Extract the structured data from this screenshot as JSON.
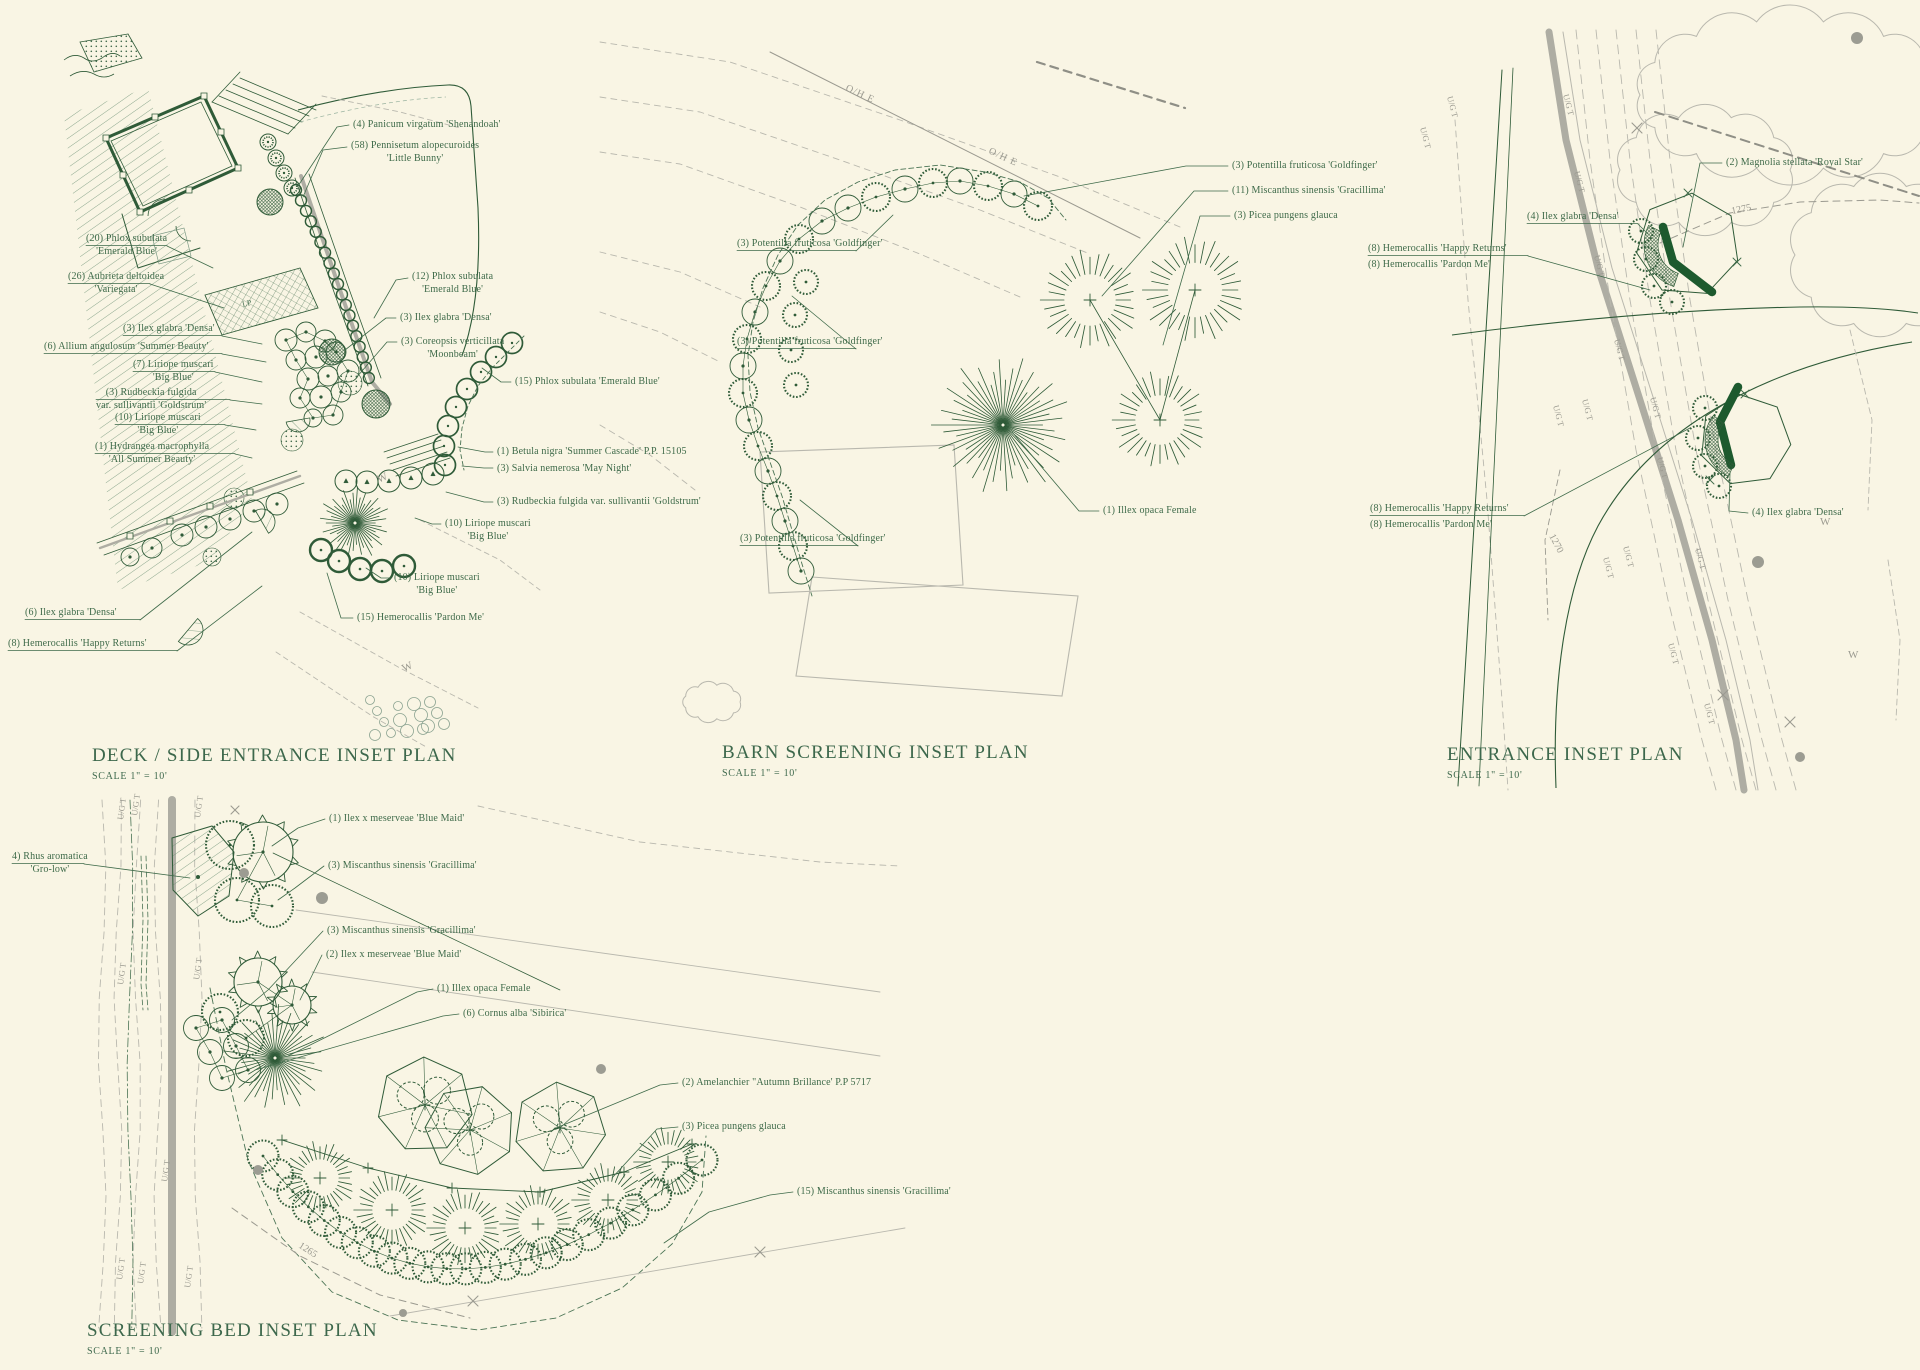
{
  "canvas": {
    "background": "#f9f5e4",
    "ink": "#2f5b38",
    "label_ink": "#3e6a49",
    "gray": "#9b9a90",
    "gray_light": "#b9b8ae",
    "road_gray": "#aeada3",
    "accent_dark": "#1d5a2e"
  },
  "plans": [
    {
      "id": "deck-side-entrance",
      "title": "DECK / SIDE ENTRANCE INSET PLAN",
      "scale_note": "SCALE 1\" = 10'",
      "labels": [
        {
          "text": "(4) Panicum virgatum 'Shenandoah'"
        },
        {
          "text": "(58) Pennisetum alopecuroides\n'Little Bunny'"
        },
        {
          "text": "(12) Phlox subulata\n'Emerald Blue'"
        },
        {
          "text": "(3) Ilex glabra 'Densa'"
        },
        {
          "text": "(3) Coreopsis verticillata\n'Moonbeam'"
        },
        {
          "text": "(15) Phlox subulata 'Emerald Blue'"
        },
        {
          "text": "(1) Betula nigra 'Summer Cascade' P.P. 15105"
        },
        {
          "text": "(3) Salvia nemerosa 'May Night'"
        },
        {
          "text": "(3) Rudbeckia fulgida var. sullivantii 'Goldstrum'"
        },
        {
          "text": "(10) Liriope muscari\n'Big Blue'"
        },
        {
          "text": "(10) Liriope muscari\n'Big Blue'"
        },
        {
          "text": "(15) Hemerocallis 'Pardon Me'"
        },
        {
          "text": "(20) Phlox subulata\n'Emerald Blue'"
        },
        {
          "text": "(26) Aubrieta deltoidea\n'Variegata'"
        },
        {
          "text": "(3) Ilex glabra 'Densa'"
        },
        {
          "text": "(6) Allium angulosum 'Summer Beauty'"
        },
        {
          "text": "(7) Liriope muscari\n'Big Blue'"
        },
        {
          "text": "(3) Rudbeckia fulgida\nvar. sullivantii 'Goldstrum'"
        },
        {
          "text": "(10) Liriope muscari\n'Big Blue'"
        },
        {
          "text": "(1) Hydrangea macrophylla\n'All Summer Beauty'"
        },
        {
          "text": "(6) Ilex glabra 'Densa'"
        },
        {
          "text": "(8) Hemerocallis 'Happy Returns'"
        }
      ]
    },
    {
      "id": "barn-screening",
      "title": "BARN SCREENING INSET PLAN",
      "scale_note": "SCALE 1\" = 10'",
      "labels": [
        {
          "text": "(3) Potentilla fruticosa 'Goldfinger'"
        },
        {
          "text": "(11) Miscanthus sinensis 'Gracillima'"
        },
        {
          "text": "(3) Picea pungens glauca"
        },
        {
          "text": "(3) Potentilla fruticosa 'Goldfinger'"
        },
        {
          "text": "(3) Potentilla fruticosa 'Goldfinger'"
        },
        {
          "text": "(3) Potentilla fruticosa 'Goldfinger'"
        },
        {
          "text": "(1) Illex opaca Female"
        }
      ]
    },
    {
      "id": "entrance",
      "title": "ENTRANCE INSET PLAN",
      "scale_note": "SCALE 1\" = 10'",
      "labels": [
        {
          "text": "(2) Magnolia stellata 'Royal Star'"
        },
        {
          "text": "(4) Ilex glabra 'Densa'"
        },
        {
          "text": "(8) Hemerocallis 'Happy Returns'"
        },
        {
          "text": "(8) Hemerocallis 'Pardon Me'"
        },
        {
          "text": "(8) Hemerocallis 'Happy Returns'"
        },
        {
          "text": "(8) Hemerocallis 'Pardon Me'"
        },
        {
          "text": "(4) Ilex glabra 'Densa'"
        }
      ]
    },
    {
      "id": "screening-bed",
      "title": "SCREENING BED INSET PLAN",
      "scale_note": "SCALE 1\" = 10'",
      "labels": [
        {
          "text": "4) Rhus aromatica\n'Gro-low'"
        },
        {
          "text": "(1) Ilex x meserveae 'Blue Maid'"
        },
        {
          "text": "(3) Miscanthus sinensis 'Gracillima'"
        },
        {
          "text": "(3) Miscanthus sinensis 'Gracillima'"
        },
        {
          "text": "(2) Ilex x meserveae 'Blue Maid'"
        },
        {
          "text": "(1) Illex opaca Female"
        },
        {
          "text": "(6) Cornus alba 'Sibirica'"
        },
        {
          "text": "(2) Amelanchier \"Autumn Brillance' P.P 5717"
        },
        {
          "text": "(3) Picea pungens glauca"
        },
        {
          "text": "(15) Miscanthus sinensis 'Gracillima'"
        }
      ]
    }
  ],
  "annotations": {
    "overhead_electric": "O/H E",
    "underground_utility": "U/G T",
    "water_main": "W",
    "fence_mark": "X",
    "lamp_post": "LP",
    "contour_1275": "1275",
    "contour_1270": "1270",
    "contour_1265": "1265"
  }
}
